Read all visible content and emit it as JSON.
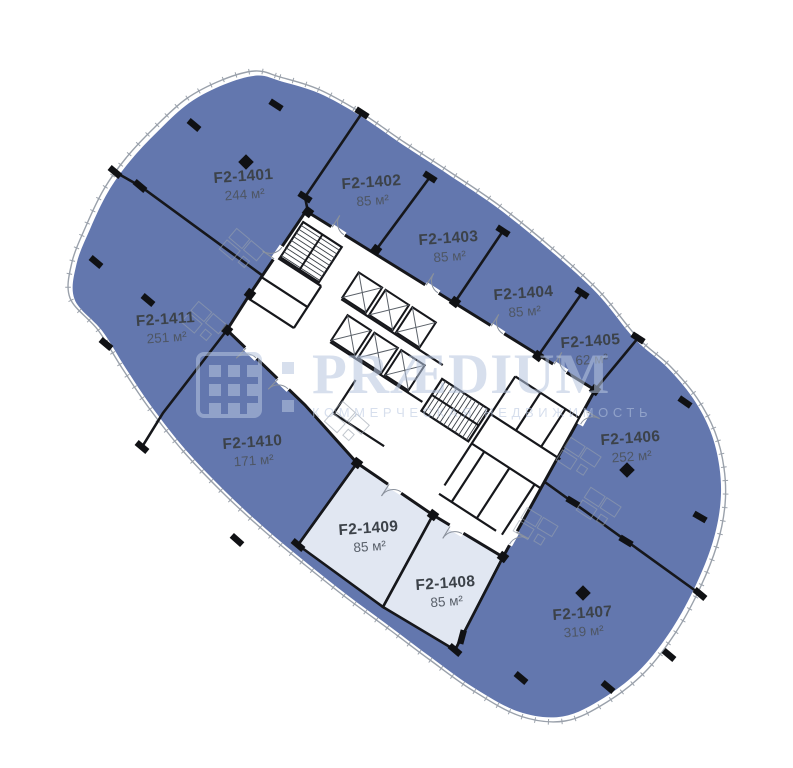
{
  "plan_title": "Floor 14 office plan",
  "colors": {
    "unit_fill": "#6377ae",
    "unit_fill_light": "#e1e7f2",
    "wall": "#16171b",
    "facade_line": "#9aa1ab",
    "label_title": "#3c4249",
    "label_area": "#4d545e",
    "watermark": "#b7c6e0"
  },
  "units": [
    {
      "id": "f2-1401",
      "name": "F2-1401",
      "area": "244 м²",
      "variant": "dark"
    },
    {
      "id": "f2-1402",
      "name": "F2-1402",
      "area": "85 м²",
      "variant": "dark"
    },
    {
      "id": "f2-1403",
      "name": "F2-1403",
      "area": "85 м²",
      "variant": "dark"
    },
    {
      "id": "f2-1404",
      "name": "F2-1404",
      "area": "85 м²",
      "variant": "dark"
    },
    {
      "id": "f2-1405",
      "name": "F2-1405",
      "area": "62 м²",
      "variant": "dark"
    },
    {
      "id": "f2-1406",
      "name": "F2-1406",
      "area": "252 м²",
      "variant": "dark"
    },
    {
      "id": "f2-1407",
      "name": "F2-1407",
      "area": "319 м²",
      "variant": "dark"
    },
    {
      "id": "f2-1408",
      "name": "F2-1408",
      "area": "85 м²",
      "variant": "light"
    },
    {
      "id": "f2-1409",
      "name": "F2-1409",
      "area": "85 м²",
      "variant": "light"
    },
    {
      "id": "f2-1410",
      "name": "F2-1410",
      "area": "171 м²",
      "variant": "dark"
    },
    {
      "id": "f2-1411",
      "name": "F2-1411",
      "area": "251 м²",
      "variant": "dark"
    }
  ],
  "watermark": {
    "brand": "PRÆDIUM",
    "tagline": "КОММЕРЧЕСКАЯ НЕДВИЖИМОСТЬ",
    "logo": "grid-logo"
  }
}
